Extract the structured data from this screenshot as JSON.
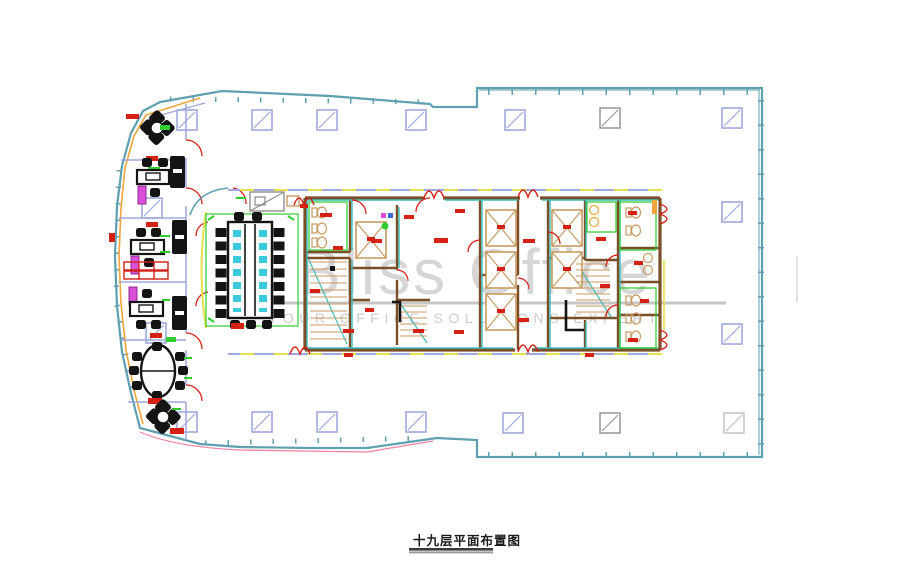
{
  "floor_plan": {
    "title": "十九层平面布置图",
    "watermark": {
      "brand": "Bliss Office",
      "tagline": "YOUR OFFICE SOLUTIONS EXPERT"
    },
    "areas": {
      "left_wing": "executive offices and meeting rooms with desks, sofas and round tables",
      "center": "large boardroom table with chairs and service core (lifts, stairs, toilets)",
      "right": "open plan area with structural column grid"
    },
    "colors": {
      "curtain_wall_teal": "#5E9FB0",
      "grid_periwinkle": "#9FA8DC",
      "inner_orange": "#F0A43C",
      "accent_yellow": "#E6E14A",
      "accent_green": "#2FCB2F",
      "annotation_red": "#D42015",
      "furniture_black": "#141414",
      "cabinet_magenta": "#D94FD9",
      "fixture_tan": "#C89A62",
      "core_wall_brown": "#7A4F28",
      "highlight_teal": "#3DBDBD",
      "table_cyan": "#3BC9DC",
      "boundary_pink": "#EE7FA0",
      "watermark_gray": "#CCCCCC"
    }
  }
}
